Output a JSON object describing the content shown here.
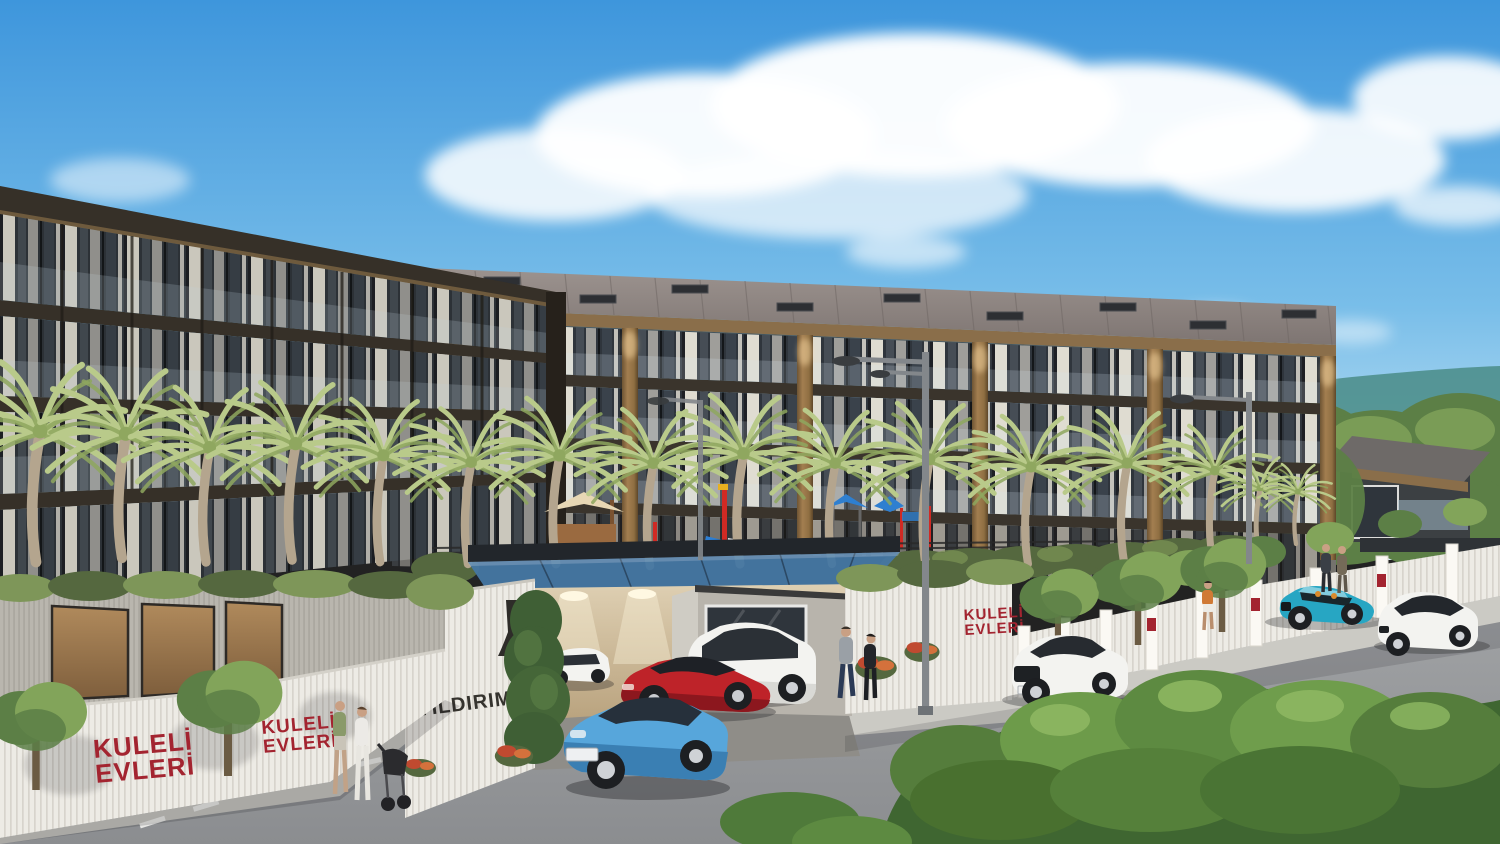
{
  "signs": {
    "brand_line1": "KULELİ",
    "brand_line2": "EVLERİ",
    "entrance_text": "YILDIRIM Y",
    "logo_caption": "YIG",
    "sales_partial_text": "dası"
  },
  "colors": {
    "sky_top": "#3E96DC",
    "sky_mid": "#79BEE9",
    "sky_horizon": "#D8EDF8",
    "cloud": "#FFFFFF",
    "mountain": "#4E8F8C",
    "forest": "#5C7F46",
    "forest_light": "#82A45A",
    "roof_light": "#9C938F",
    "roof_dark": "#7E7572",
    "roof_seam": "#6F6764",
    "fascia_wood": "#8A6E4A",
    "band_dark": "#3A342C",
    "column_wood": "#A37E50",
    "column_wood_dark": "#6E5433",
    "glass_dark": "#2F353C",
    "curtain": "#E9E4D9",
    "palm_frond": "#B9CA8A",
    "palm_frond_dark": "#8FA75F",
    "palm_trunk": "#B4A58E",
    "hedge": "#55683F",
    "hedge_light": "#7C9455",
    "ivy": "#7E9659",
    "wall_white": "#EDEBE5",
    "wall_rib": "#D7D4CC",
    "wall_gray": "#B9B6AE",
    "sign_red": "#A32430",
    "canopy_glass": "#4677A3",
    "canopy_frame": "#22262B",
    "garage_warm": "#DECFB2",
    "garage_glow": "#FBF2D9",
    "road_light": "#A6A8AA",
    "road_dark": "#8B8D90",
    "road_line": "#F2F2EF",
    "sidewalk": "#CBCAC4",
    "car_blue": "#57A6DB",
    "car_red": "#BE2329",
    "car_white": "#F3F3F0",
    "car_teal": "#27A6C3",
    "pole_gray": "#83878B",
    "skin": "#C9A084",
    "text_dark": "#35332E"
  }
}
